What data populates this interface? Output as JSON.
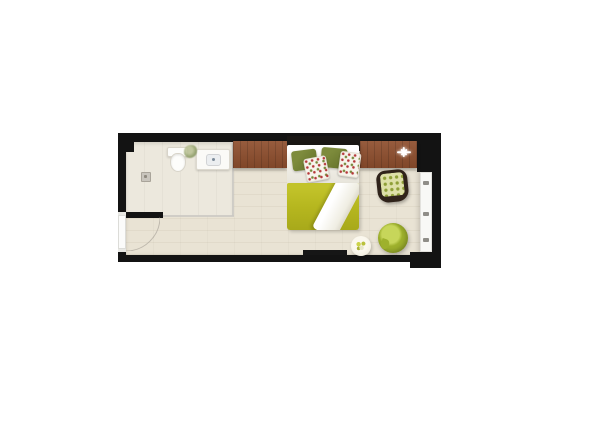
{
  "scene": {
    "kind": "top-down-floor-plan-render",
    "description": "hotel studio room floor plan with open en-suite bathroom, double bed, consoles, chairs and balcony window"
  },
  "palette": {
    "wall": "#131313",
    "floor_wood": "#e9e3d4",
    "floor_tile": "#ece8dd",
    "glass_grey": "#c9c7c2",
    "console_brown": "#8e4e2d",
    "headboard": "#1a1714",
    "sheet_white": "#f2f0e9",
    "pillow_olive": "#6d7b31",
    "floral_base": "#f7f4ec",
    "floral_red": "#b5383a",
    "floral_green": "#78883b",
    "duvet_green": "#b6b71f",
    "throw_white": "#efede2",
    "chair_frame": "#30231a",
    "check_base": "#dee0a8",
    "check_dot": "#8f9f37",
    "armchair_dark": "#8a9c1f",
    "armchair_mid": "#9eb12c",
    "armchair_light": "#c7d65a",
    "table_cream": "#f2eee0",
    "flower_yellow": "#ccd34a",
    "window_white": "#f8f8f6",
    "door_white": "#fbfbfa",
    "drain_grey": "#c9c5bd",
    "basin_grey": "#7d8b99",
    "plant_green": "#8a9a62"
  },
  "elements": [
    "outer-walls",
    "bathroom-floor",
    "toilet",
    "sink-counter",
    "plant",
    "floor-drain",
    "entrance-door",
    "door-swing-arc",
    "console-left",
    "console-right",
    "sparkle-icon",
    "bed-headboard",
    "bed-sheet",
    "pillow-olive-left",
    "pillow-olive-right",
    "pillow-floral-left",
    "pillow-floral-right",
    "duvet",
    "bed-throw",
    "checkered-chair",
    "green-armchair",
    "side-table",
    "flower-decor",
    "tv-board",
    "window-right"
  ]
}
